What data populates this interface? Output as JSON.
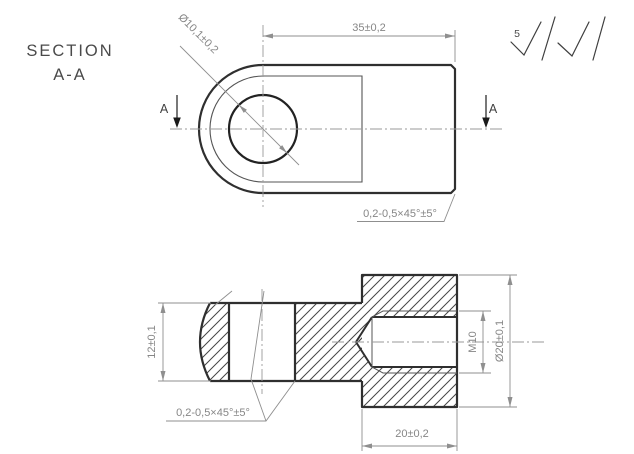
{
  "drawing": {
    "section_label_line1": "SECTION",
    "section_label_line2": "A-A",
    "roughness_value": "5",
    "top_view": {
      "length_dim": "35±0,2",
      "hole_diameter_dim": "Ø10,1±0,2",
      "chamfer_note": "0,2-0,5×45°±5°",
      "section_marker_left": "A",
      "section_marker_right": "A"
    },
    "section_view": {
      "thickness_dim": "12±0,1",
      "chamfer_note": "0,2-0,5×45°±5°",
      "thread_dim": "M10",
      "outer_diameter_dim": "Ø20±0,1",
      "cylinder_length_dim": "20±0,2"
    },
    "colors": {
      "outline": "#2f2f2f",
      "thin_line": "#555555",
      "dimension": "#8f8f8f",
      "background": "#ffffff"
    }
  }
}
